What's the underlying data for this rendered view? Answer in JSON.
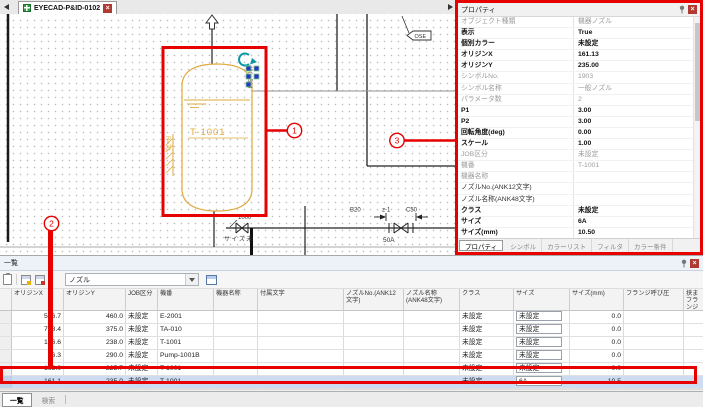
{
  "tab_bar": {
    "document_tab": {
      "label": "EYECAD-P&ID-0102",
      "close_glyph": "×"
    }
  },
  "canvas": {
    "drawing": {
      "tank_tag": "T-1001",
      "tank_dimension": "400×504",
      "support_label": "R=70",
      "line_number": "1000",
      "size_note": "サイズ未",
      "valve_size_label": "50A",
      "dim_left": "B20",
      "dim_mid": "z-1",
      "dim_right": "C50",
      "flag_label": "OSE"
    },
    "callouts": {
      "one": "1",
      "two": "2",
      "three": "3"
    }
  },
  "properties_panel": {
    "title": "プロパティ",
    "close_glyph": "×",
    "rows": [
      {
        "label": "オブジェクト種類",
        "value": "機器ノズル",
        "emphasis": "muted"
      },
      {
        "label": "表示",
        "value": "True",
        "emphasis": "strong"
      },
      {
        "label": "個別カラー",
        "value": "未設定",
        "emphasis": "strong"
      },
      {
        "label": "オリジンX",
        "value": "161.13",
        "emphasis": "strong"
      },
      {
        "label": "オリジンY",
        "value": "235.00",
        "emphasis": "strong"
      },
      {
        "label": "シンボルNo.",
        "value": "1903",
        "emphasis": "muted"
      },
      {
        "label": "シンボル名称",
        "value": "一般ノズル",
        "emphasis": "muted"
      },
      {
        "label": "パラメータ数",
        "value": "2",
        "emphasis": "muted"
      },
      {
        "label": "P1",
        "value": "3.00",
        "emphasis": "strong"
      },
      {
        "label": "P2",
        "value": "3.00",
        "emphasis": "strong"
      },
      {
        "label": "回転角度(deg)",
        "value": "0.00",
        "emphasis": "strong"
      },
      {
        "label": "スケール",
        "value": "1.00",
        "emphasis": "strong"
      },
      {
        "label": "JOB区分",
        "value": "未設定",
        "emphasis": "muted"
      },
      {
        "label": "機番",
        "value": "T-1001",
        "emphasis": "muted"
      },
      {
        "label": "機器名称",
        "value": "",
        "emphasis": "muted"
      },
      {
        "label": "ノズルNo.(ANK12文字)",
        "value": "",
        "emphasis": "normal"
      },
      {
        "label": "ノズル名称(ANK48文字)",
        "value": "",
        "emphasis": "normal"
      },
      {
        "label": "クラス",
        "value": "未設定",
        "emphasis": "strong"
      },
      {
        "label": "サイズ",
        "value": "6A",
        "emphasis": "strong"
      },
      {
        "label": "サイズ(mm)",
        "value": "10.50",
        "emphasis": "strong"
      },
      {
        "label": "フランジ呼び圧",
        "value": "",
        "emphasis": "muted"
      },
      {
        "label": "挟まフランジ厚さ[mm]",
        "value": "",
        "emphasis": "muted"
      }
    ],
    "tabs": [
      {
        "label": "プロパティ",
        "active": true
      },
      {
        "label": "シンボル",
        "active": false
      },
      {
        "label": "カラーリスト",
        "active": false
      },
      {
        "label": "フィルタ",
        "active": false
      },
      {
        "label": "カラー条件",
        "active": false
      }
    ]
  },
  "list_panel": {
    "title": "一覧",
    "close_glyph": "×",
    "toolbar": {
      "filter_value": "ノズル"
    },
    "columns": [
      "",
      "オリジンX",
      "オリジンY",
      "JOB区分",
      "機番",
      "機器名称",
      "付属文字",
      "ノズルNo.(ANK12文字)",
      "ノズル名称(ANK48文字)",
      "クラス",
      "サイズ",
      "サイズ(mm)",
      "フランジ呼び圧",
      "挟まフランジ厚"
    ],
    "rows": [
      {
        "origin_x": "576.7",
        "origin_y": "460.0",
        "job": "未設定",
        "equip_no": "E-2001",
        "equip_name": "",
        "attached_text": "",
        "nozzle_no": "",
        "nozzle_name": "",
        "class": "未設定",
        "size": "未設定",
        "size_mm": "0.0",
        "flange_rating": "",
        "selected": false
      },
      {
        "origin_x": "768.4",
        "origin_y": "375.0",
        "job": "未設定",
        "equip_no": "TA-010",
        "equip_name": "",
        "attached_text": "",
        "nozzle_no": "",
        "nozzle_name": "",
        "class": "未設定",
        "size": "未設定",
        "size_mm": "0.0",
        "flange_rating": "",
        "selected": false
      },
      {
        "origin_x": "146.6",
        "origin_y": "238.0",
        "job": "未設定",
        "equip_no": "T-1001",
        "equip_name": "",
        "attached_text": "",
        "nozzle_no": "",
        "nozzle_name": "",
        "class": "未設定",
        "size": "未設定",
        "size_mm": "0.0",
        "flange_rating": "",
        "selected": false
      },
      {
        "origin_x": "96.3",
        "origin_y": "290.0",
        "job": "未設定",
        "equip_no": "Pump-1001B",
        "equip_name": "",
        "attached_text": "",
        "nozzle_no": "",
        "nozzle_name": "",
        "class": "未設定",
        "size": "未設定",
        "size_mm": "0.0",
        "flange_rating": "",
        "selected": false
      },
      {
        "origin_x": "163.0",
        "origin_y": "225.7",
        "job": "未設定",
        "equip_no": "T-1001",
        "equip_name": "",
        "attached_text": "",
        "nozzle_no": "",
        "nozzle_name": "",
        "class": "未設定",
        "size": "未設定",
        "size_mm": "0.0",
        "flange_rating": "",
        "selected": false
      },
      {
        "origin_x": "161.1",
        "origin_y": "235.0",
        "job": "未設定",
        "equip_no": "T-1001",
        "equip_name": "",
        "attached_text": "",
        "nozzle_no": "",
        "nozzle_name": "",
        "class": "未設定",
        "size": "6A",
        "size_mm": "10.5",
        "flange_rating": "",
        "selected": true
      }
    ],
    "bottom_tabs": [
      {
        "label": "一覧",
        "active": true
      },
      {
        "label": "検索",
        "active": false
      }
    ]
  }
}
